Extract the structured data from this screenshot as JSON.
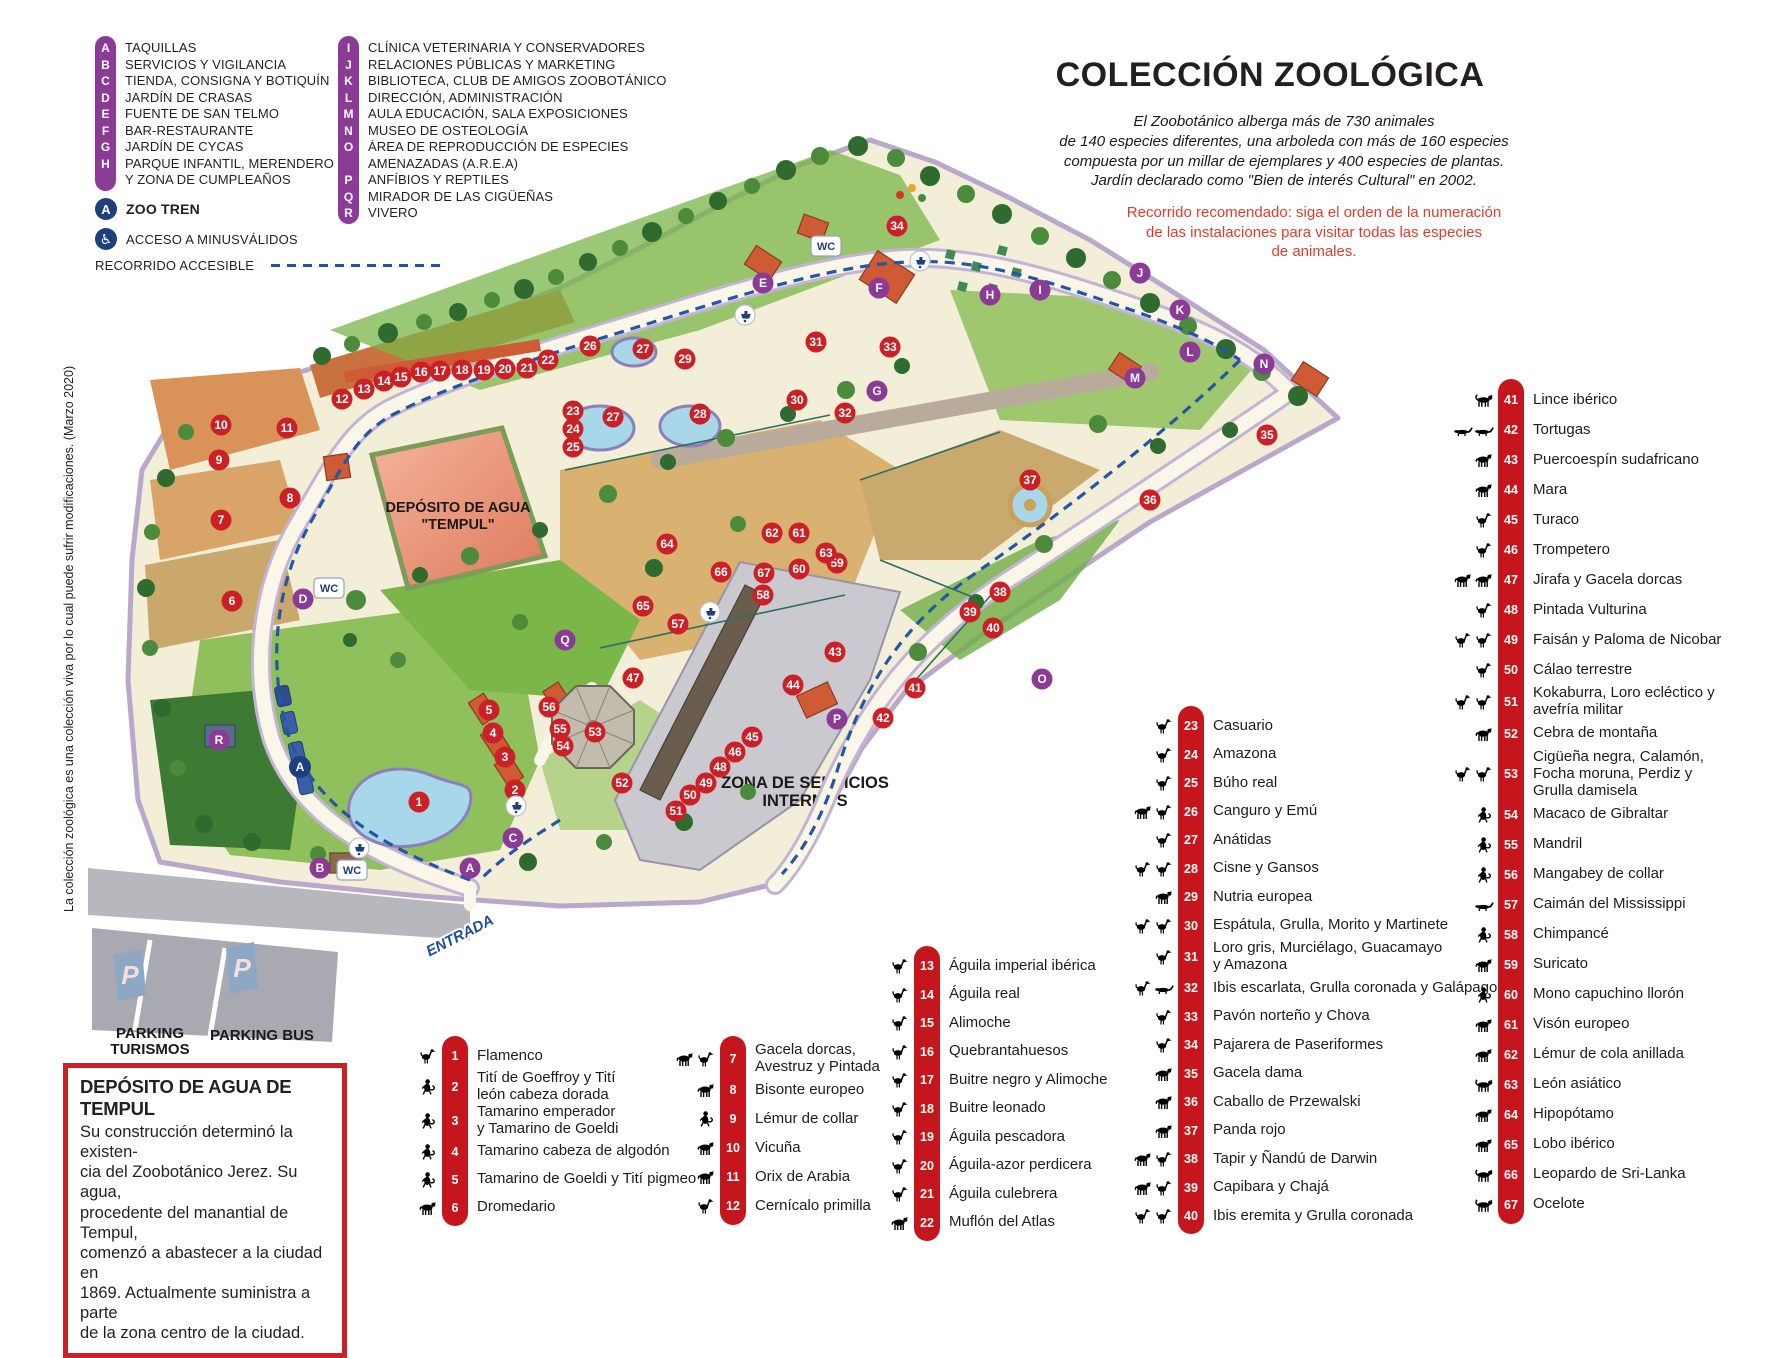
{
  "colors": {
    "purple": "#8b3a96",
    "marker_red": "#cc2027",
    "bar_red": "#c4161c",
    "navy": "#1e3f7d",
    "route_blue": "#2456a4",
    "text_red": "#e23b2e",
    "cream": "#f3eed8",
    "salmon": "#ef9b80"
  },
  "legend_a": {
    "items": [
      {
        "letter": "A",
        "label": "TAQUILLAS"
      },
      {
        "letter": "B",
        "label": "SERVICIOS Y VIGILANCIA"
      },
      {
        "letter": "C",
        "label": "TIENDA, CONSIGNA Y BOTIQUÍN"
      },
      {
        "letter": "D",
        "label": "JARDÍN DE CRASAS"
      },
      {
        "letter": "E",
        "label": "FUENTE DE SAN TELMO"
      },
      {
        "letter": "F",
        "label": "BAR-RESTAURANTE"
      },
      {
        "letter": "G",
        "label": "JARDÍN DE CYCAS"
      },
      {
        "letter": "H",
        "label": "PARQUE INFANTIL, MERENDERO\nY ZONA DE CUMPLEAÑOS"
      }
    ]
  },
  "legend_b": {
    "items": [
      {
        "letter": "I",
        "label": "CLÍNICA VETERINARIA Y CONSERVADORES"
      },
      {
        "letter": "J",
        "label": "RELACIONES PÚBLICAS Y MARKETING"
      },
      {
        "letter": "K",
        "label": "BIBLIOTECA, CLUB DE AMIGOS ZOOBOTÁNICO"
      },
      {
        "letter": "L",
        "label": "DIRECCIÓN, ADMINISTRACIÓN"
      },
      {
        "letter": "M",
        "label": "AULA EDUCACIÓN, SALA EXPOSICIONES"
      },
      {
        "letter": "N",
        "label": "MUSEO DE OSTEOLOGÍA"
      },
      {
        "letter": "O",
        "label": "ÁREA DE REPRODUCCIÓN DE ESPECIES\nAMENAZADAS (A.R.E.A)"
      },
      {
        "letter": "P",
        "label": "ANFÍBIOS Y REPTILES"
      },
      {
        "letter": "Q",
        "label": "MIRADOR DE LAS CIGÜEÑAS"
      },
      {
        "letter": "R",
        "label": "VIVERO"
      }
    ]
  },
  "extras": {
    "zoo_tren": "ZOO TREN",
    "zoo_tren_letter": "A",
    "acceso": "ACCESO A MINUSVÁLIDOS",
    "wheelchair_glyph": "♿",
    "recorrido": "RECORRIDO ACCESIBLE"
  },
  "header": {
    "title": "COLECCIÓN ZOOLÓGICA",
    "intro": "El Zoobotánico alberga más de 730 animales\nde 140 especies diferentes,  una arboleda con más de 160 especies\ncompuesta por un millar de  ejemplares y 400 especies de plantas.\nJardín declarado como \"Bien de interés Cultural\" en 2002.",
    "recommend": "Recorrido recomendado: siga el orden de la numeración\nde las instalaciones para visitar todas las especies\nde animales."
  },
  "species_col1": [
    {
      "num": "1",
      "label": "Flamenco",
      "icons": [
        "bird"
      ]
    },
    {
      "num": "2",
      "label": "Tití de Goeffroy y Tití\nleón cabeza dorada",
      "icons": [
        "monkey"
      ]
    },
    {
      "num": "3",
      "label": "Tamarino emperador\ny Tamarino de Goeldi",
      "icons": [
        "monkey"
      ]
    },
    {
      "num": "4",
      "label": "Tamarino cabeza de algodón",
      "icons": [
        "monkey"
      ]
    },
    {
      "num": "5",
      "label": "Tamarino de Goeldi y Tití pigmeo",
      "icons": [
        "monkey"
      ]
    },
    {
      "num": "6",
      "label": "Dromedario",
      "icons": [
        "quadruped"
      ]
    }
  ],
  "species_col2": [
    {
      "num": "7",
      "label": "Gacela dorcas,\nAvestruz y Pintada",
      "icons": [
        "quadruped",
        "bird"
      ]
    },
    {
      "num": "8",
      "label": "Bisonte europeo",
      "icons": [
        "quadruped"
      ]
    },
    {
      "num": "9",
      "label": "Lémur de collar",
      "icons": [
        "monkey"
      ]
    },
    {
      "num": "10",
      "label": "Vicuña",
      "icons": [
        "quadruped"
      ]
    },
    {
      "num": "11",
      "label": "Orix de Arabia",
      "icons": [
        "quadruped"
      ]
    },
    {
      "num": "12",
      "label": "Cernícalo primilla",
      "icons": [
        "bird"
      ]
    }
  ],
  "species_col3": [
    {
      "num": "13",
      "label": "Águila imperial ibérica",
      "icons": [
        "bird"
      ]
    },
    {
      "num": "14",
      "label": "Águila real",
      "icons": [
        "bird"
      ]
    },
    {
      "num": "15",
      "label": "Alimoche",
      "icons": [
        "bird"
      ]
    },
    {
      "num": "16",
      "label": "Quebrantahuesos",
      "icons": [
        "bird"
      ]
    },
    {
      "num": "17",
      "label": "Buitre negro y Alimoche",
      "icons": [
        "bird"
      ]
    },
    {
      "num": "18",
      "label": "Buitre leonado",
      "icons": [
        "bird"
      ]
    },
    {
      "num": "19",
      "label": "Águila pescadora",
      "icons": [
        "bird"
      ]
    },
    {
      "num": "20",
      "label": "Águila-azor perdicera",
      "icons": [
        "bird"
      ]
    },
    {
      "num": "21",
      "label": "Águila culebrera",
      "icons": [
        "bird"
      ]
    },
    {
      "num": "22",
      "label": "Muflón del Atlas",
      "icons": [
        "quadruped"
      ]
    }
  ],
  "species_col4": [
    {
      "num": "23",
      "label": "Casuario",
      "icons": [
        "bird"
      ]
    },
    {
      "num": "24",
      "label": "Amazona",
      "icons": [
        "bird"
      ]
    },
    {
      "num": "25",
      "label": "Búho real",
      "icons": [
        "bird"
      ]
    },
    {
      "num": "26",
      "label": "Canguro y Emú",
      "icons": [
        "quadruped",
        "bird"
      ]
    },
    {
      "num": "27",
      "label": "Anátidas",
      "icons": [
        "bird"
      ]
    },
    {
      "num": "28",
      "label": "Cisne y Gansos",
      "icons": [
        "bird",
        "bird"
      ]
    },
    {
      "num": "29",
      "label": "Nutria europea",
      "icons": [
        "quadruped"
      ]
    },
    {
      "num": "30",
      "label": "Espátula, Grulla, Morito y Martinete",
      "icons": [
        "bird",
        "bird"
      ]
    },
    {
      "num": "31",
      "label": "Loro gris, Murciélago, Guacamayo\ny Amazona",
      "icons": [
        "bird"
      ]
    },
    {
      "num": "32",
      "label": "Ibis escarlata, Grulla coronada y Galápago",
      "icons": [
        "bird",
        "reptile"
      ]
    },
    {
      "num": "33",
      "label": "Pavón norteño y Chova",
      "icons": [
        "bird"
      ]
    },
    {
      "num": "34",
      "label": "Pajarera de Paseriformes",
      "icons": [
        "bird"
      ]
    },
    {
      "num": "35",
      "label": "Gacela dama",
      "icons": [
        "quadruped"
      ]
    },
    {
      "num": "36",
      "label": "Caballo de Przewalski",
      "icons": [
        "quadruped"
      ]
    },
    {
      "num": "37",
      "label": "Panda rojo",
      "icons": [
        "quadruped"
      ]
    },
    {
      "num": "38",
      "label": "Tapir y Ñandú de Darwin",
      "icons": [
        "quadruped",
        "bird"
      ]
    },
    {
      "num": "39",
      "label": "Capibara y Chajá",
      "icons": [
        "quadruped",
        "bird"
      ]
    },
    {
      "num": "40",
      "label": "Ibis eremita y Grulla coronada",
      "icons": [
        "bird",
        "bird"
      ]
    }
  ],
  "species_col5": [
    {
      "num": "41",
      "label": "Lince ibérico",
      "icons": [
        "bigcat"
      ]
    },
    {
      "num": "42",
      "label": "Tortugas",
      "icons": [
        "reptile",
        "reptile"
      ]
    },
    {
      "num": "43",
      "label": "Puercoespín sudafricano",
      "icons": [
        "quadruped"
      ]
    },
    {
      "num": "44",
      "label": "Mara",
      "icons": [
        "quadruped"
      ]
    },
    {
      "num": "45",
      "label": "Turaco",
      "icons": [
        "bird"
      ]
    },
    {
      "num": "46",
      "label": "Trompetero",
      "icons": [
        "bird"
      ]
    },
    {
      "num": "47",
      "label": "Jirafa y Gacela dorcas",
      "icons": [
        "quadruped",
        "quadruped"
      ]
    },
    {
      "num": "48",
      "label": "Pintada Vulturina",
      "icons": [
        "bird"
      ]
    },
    {
      "num": "49",
      "label": "Faisán y Paloma de Nicobar",
      "icons": [
        "bird",
        "bird"
      ]
    },
    {
      "num": "50",
      "label": "Cálao terrestre",
      "icons": [
        "bird"
      ]
    },
    {
      "num": "51",
      "label": "Kokaburra, Loro ecléctico y\navefría militar",
      "icons": [
        "bird",
        "bird"
      ]
    },
    {
      "num": "52",
      "label": "Cebra de montaña",
      "icons": [
        "quadruped"
      ]
    },
    {
      "num": "53",
      "label": "Cigüeña negra, Calamón,\nFocha moruna, Perdiz y\nGrulla damisela",
      "icons": [
        "bird",
        "bird"
      ]
    },
    {
      "num": "54",
      "label": "Macaco de Gibraltar",
      "icons": [
        "monkey"
      ]
    },
    {
      "num": "55",
      "label": "Mandril",
      "icons": [
        "monkey"
      ]
    },
    {
      "num": "56",
      "label": "Mangabey de collar",
      "icons": [
        "monkey"
      ]
    },
    {
      "num": "57",
      "label": "Caimán del Mississippi",
      "icons": [
        "reptile"
      ]
    },
    {
      "num": "58",
      "label": "Chimpancé",
      "icons": [
        "monkey"
      ]
    },
    {
      "num": "59",
      "label": "Suricato",
      "icons": [
        "quadruped"
      ]
    },
    {
      "num": "60",
      "label": "Mono capuchino llorón",
      "icons": [
        "monkey"
      ]
    },
    {
      "num": "61",
      "label": "Visón europeo",
      "icons": [
        "quadruped"
      ]
    },
    {
      "num": "62",
      "label": "Lémur de cola anillada",
      "icons": [
        "quadruped"
      ]
    },
    {
      "num": "63",
      "label": "León asiático",
      "icons": [
        "bigcat"
      ]
    },
    {
      "num": "64",
      "label": "Hipopótamo",
      "icons": [
        "quadruped"
      ]
    },
    {
      "num": "65",
      "label": "Lobo ibérico",
      "icons": [
        "quadruped"
      ]
    },
    {
      "num": "66",
      "label": "Leopardo de Sri-Lanka",
      "icons": [
        "bigcat"
      ]
    },
    {
      "num": "67",
      "label": "Ocelote",
      "icons": [
        "bigcat"
      ]
    }
  ],
  "tempul_box": {
    "title": "DEPÓSITO DE AGUA DE TEMPUL",
    "body": "Su construcción determinó la existen-\ncia del Zoobotánico Jerez. Su agua,\nprocedente del manantial de Tempul,\ncomenzó a abastecer a la ciudad en\n1869. Actualmente suministra a parte\nde la zona centro de la ciudad."
  },
  "side_note": "La colección zoológica  es una colección viva por lo cual puede sufrir modificaciones. (Marzo 2020)",
  "map": {
    "labels": {
      "deposito_l1": "DEPÓSITO DE AGUA",
      "deposito_l2": "\"TEMPUL\"",
      "servicios_l1": "ZONA DE SERVICIOS",
      "servicios_l2": "INTERNOS",
      "entrada": "ENTRADA",
      "parking_turismos_l1": "PARKING",
      "parking_turismos_l2": "TURISMOS",
      "parking_bus": "PARKING BUS",
      "wc": "WC",
      "p_sign": "P",
      "train_letter": "A"
    },
    "markers": {
      "numbers": [
        {
          "n": "1",
          "x": 419,
          "y": 802
        },
        {
          "n": "2",
          "x": 515,
          "y": 790
        },
        {
          "n": "3",
          "x": 505,
          "y": 757
        },
        {
          "n": "4",
          "x": 493,
          "y": 733
        },
        {
          "n": "5",
          "x": 489,
          "y": 710
        },
        {
          "n": "6",
          "x": 232,
          "y": 601
        },
        {
          "n": "7",
          "x": 221,
          "y": 520
        },
        {
          "n": "8",
          "x": 290,
          "y": 498
        },
        {
          "n": "9",
          "x": 219,
          "y": 460
        },
        {
          "n": "10",
          "x": 221,
          "y": 425
        },
        {
          "n": "11",
          "x": 287,
          "y": 428
        },
        {
          "n": "12",
          "x": 342,
          "y": 399
        },
        {
          "n": "13",
          "x": 364,
          "y": 389
        },
        {
          "n": "14",
          "x": 384,
          "y": 381
        },
        {
          "n": "15",
          "x": 401,
          "y": 377
        },
        {
          "n": "16",
          "x": 421,
          "y": 372
        },
        {
          "n": "17",
          "x": 440,
          "y": 371
        },
        {
          "n": "18",
          "x": 462,
          "y": 370
        },
        {
          "n": "19",
          "x": 484,
          "y": 370
        },
        {
          "n": "20",
          "x": 505,
          "y": 369
        },
        {
          "n": "21",
          "x": 527,
          "y": 368
        },
        {
          "n": "22",
          "x": 548,
          "y": 360
        },
        {
          "n": "23",
          "x": 573,
          "y": 411
        },
        {
          "n": "24",
          "x": 573,
          "y": 429
        },
        {
          "n": "25",
          "x": 573,
          "y": 447
        },
        {
          "n": "26",
          "x": 590,
          "y": 346
        },
        {
          "n": "27",
          "x": 643,
          "y": 349
        },
        {
          "n": "27",
          "x": 613,
          "y": 417
        },
        {
          "n": "28",
          "x": 700,
          "y": 414
        },
        {
          "n": "29",
          "x": 685,
          "y": 359
        },
        {
          "n": "30",
          "x": 797,
          "y": 400
        },
        {
          "n": "31",
          "x": 816,
          "y": 342
        },
        {
          "n": "32",
          "x": 845,
          "y": 413
        },
        {
          "n": "33",
          "x": 890,
          "y": 347
        },
        {
          "n": "34",
          "x": 897,
          "y": 226
        },
        {
          "n": "35",
          "x": 1267,
          "y": 435
        },
        {
          "n": "36",
          "x": 1150,
          "y": 500
        },
        {
          "n": "37",
          "x": 1030,
          "y": 480
        },
        {
          "n": "38",
          "x": 1000,
          "y": 592
        },
        {
          "n": "39",
          "x": 970,
          "y": 612
        },
        {
          "n": "40",
          "x": 993,
          "y": 628
        },
        {
          "n": "41",
          "x": 915,
          "y": 688
        },
        {
          "n": "42",
          "x": 883,
          "y": 718
        },
        {
          "n": "43",
          "x": 835,
          "y": 652
        },
        {
          "n": "44",
          "x": 793,
          "y": 685
        },
        {
          "n": "45",
          "x": 752,
          "y": 737
        },
        {
          "n": "46",
          "x": 735,
          "y": 752
        },
        {
          "n": "47",
          "x": 633,
          "y": 678
        },
        {
          "n": "48",
          "x": 720,
          "y": 767
        },
        {
          "n": "49",
          "x": 706,
          "y": 783
        },
        {
          "n": "50",
          "x": 690,
          "y": 795
        },
        {
          "n": "51",
          "x": 676,
          "y": 811
        },
        {
          "n": "52",
          "x": 622,
          "y": 783
        },
        {
          "n": "53",
          "x": 595,
          "y": 732
        },
        {
          "n": "54",
          "x": 563,
          "y": 746
        },
        {
          "n": "55",
          "x": 560,
          "y": 729
        },
        {
          "n": "56",
          "x": 549,
          "y": 707
        },
        {
          "n": "57",
          "x": 678,
          "y": 624
        },
        {
          "n": "58",
          "x": 763,
          "y": 595
        },
        {
          "n": "59",
          "x": 837,
          "y": 563
        },
        {
          "n": "60",
          "x": 799,
          "y": 569
        },
        {
          "n": "61",
          "x": 799,
          "y": 533
        },
        {
          "n": "62",
          "x": 772,
          "y": 533
        },
        {
          "n": "63",
          "x": 826,
          "y": 553
        },
        {
          "n": "64",
          "x": 667,
          "y": 544
        },
        {
          "n": "65",
          "x": 643,
          "y": 606
        },
        {
          "n": "66",
          "x": 721,
          "y": 572
        },
        {
          "n": "67",
          "x": 764,
          "y": 573
        }
      ],
      "letters": [
        {
          "n": "A",
          "x": 470,
          "y": 868
        },
        {
          "n": "B",
          "x": 320,
          "y": 868
        },
        {
          "n": "C",
          "x": 513,
          "y": 838
        },
        {
          "n": "D",
          "x": 303,
          "y": 599
        },
        {
          "n": "E",
          "x": 763,
          "y": 283
        },
        {
          "n": "F",
          "x": 879,
          "y": 288
        },
        {
          "n": "G",
          "x": 877,
          "y": 391
        },
        {
          "n": "H",
          "x": 990,
          "y": 295
        },
        {
          "n": "I",
          "x": 1040,
          "y": 290
        },
        {
          "n": "J",
          "x": 1140,
          "y": 273
        },
        {
          "n": "K",
          "x": 1180,
          "y": 310
        },
        {
          "n": "L",
          "x": 1190,
          "y": 352
        },
        {
          "n": "M",
          "x": 1135,
          "y": 378
        },
        {
          "n": "N",
          "x": 1264,
          "y": 364
        },
        {
          "n": "O",
          "x": 1042,
          "y": 679
        },
        {
          "n": "P",
          "x": 837,
          "y": 719
        },
        {
          "n": "Q",
          "x": 565,
          "y": 640
        },
        {
          "n": "R",
          "x": 219,
          "y": 740
        }
      ],
      "wc": [
        {
          "x": 352,
          "y": 870
        },
        {
          "x": 329,
          "y": 588
        },
        {
          "x": 826,
          "y": 246
        }
      ],
      "taps": [
        {
          "x": 359,
          "y": 848
        },
        {
          "x": 516,
          "y": 806
        },
        {
          "x": 710,
          "y": 612
        },
        {
          "x": 745,
          "y": 315
        },
        {
          "x": 920,
          "y": 261
        }
      ],
      "train_stops": [
        {
          "x": 300,
          "y": 767
        }
      ]
    }
  }
}
